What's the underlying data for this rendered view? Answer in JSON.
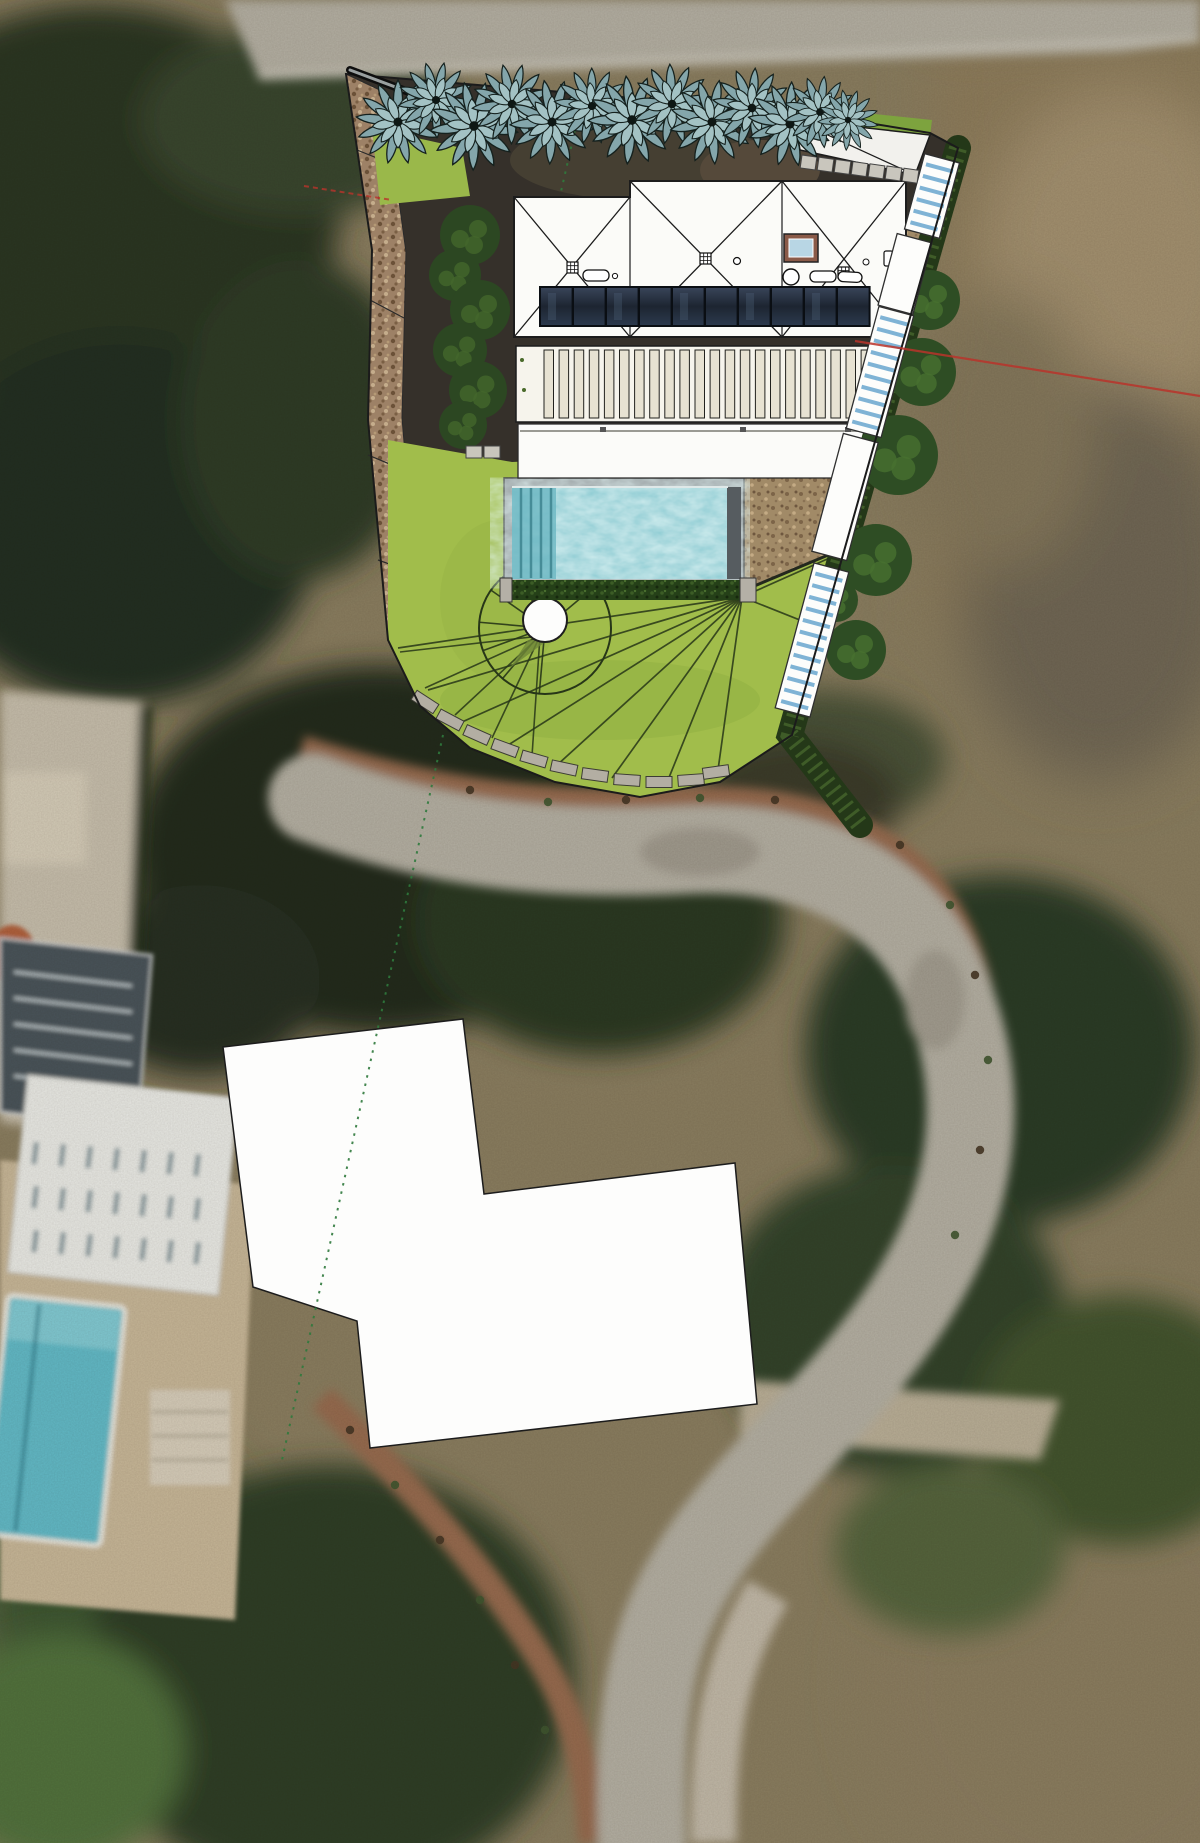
{
  "colors": {
    "bg_base": "#8a7d60",
    "road": "#b4afa3",
    "sidewalk_brown": "#966a50",
    "photo_tree_dark": "#2b3424",
    "photo_field_tan": "#8d7b5c",
    "plot_shadow": "#35302a",
    "lawn": "#a1bd4b",
    "lawn_wedge": "#9ab84a",
    "pool_water": "#79c4cd",
    "pool_step_line": "#468c97",
    "roof_white": "#fbfbf8",
    "terrace_white": "#fbfbf9",
    "louver_bg": "#f6f4ec",
    "louver_slat": "#e7e2d2",
    "solar_dark": "#242e3a",
    "plan_line": "#1b1b1b",
    "fan_line": "#273618",
    "wall_block": "#b3aea3",
    "hedge_dark": "#2c4722",
    "hedge_light": "#43662c",
    "tree_leaf": "#84a6ab",
    "tree_leaf_inner": "#a3c2c4",
    "tree_outline": "#15211e",
    "white_mask": "#fdfdfc",
    "dotted_green": "#2f7a3d",
    "red_line": "#b9342b",
    "deck": "#c7b698",
    "bldg_roof_dark": "#49525a",
    "bldg_roof_white": "#e9e9e5",
    "bldg_pool": "#62b9c7",
    "steps_tread_blue": "#7fb3d5",
    "skylight_frame": "#8a5a48",
    "skylight_glass": "#b8d6e4",
    "green_strip": "#7da33e"
  },
  "plan": {
    "boundary_points": "346,74 800,112 930,133 958,148 792,735 720,782 640,797 555,782 470,748 420,706 388,640 368,420 372,250",
    "gravel_points": "346,74 372,250 368,420 388,640 420,632 402,418 406,252 384,92",
    "lawn_points": "388,440 512,462 740,452 876,445 792,735 720,782 640,797 555,782 470,748 420,706 388,640",
    "lawn_wedge_points": "372,128 462,148 470,196 380,205",
    "roof_points": "514,197 630,197 630,181 906,181 906,337 514,337",
    "louver_points": "516,346 899,346 877,422 516,422",
    "terrace_points": "518,424 872,424 857,478 518,478",
    "brown_se_points": "740,452 878,445 852,545 740,592",
    "brown_ne_points": "902,222 938,218 918,320 902,316",
    "green_ne_points": "902,316 916,320 876,460",
    "driveway_points": "795,120 930,135 915,175 800,150",
    "driveway_green_points": "798,106 932,120 930,136 796,122",
    "white_mask_points": "223,1047 463,1019 484,1194 735,1163 757,1404 370,1448 357,1321 253,1287",
    "tree_row": [
      [
        398,
        122,
        1,
        0
      ],
      [
        436,
        100,
        0.9,
        40
      ],
      [
        474,
        126,
        1.05,
        15
      ],
      [
        512,
        104,
        0.95,
        70
      ],
      [
        552,
        122,
        1,
        100
      ],
      [
        592,
        106,
        0.9,
        55
      ],
      [
        632,
        120,
        1.05,
        20
      ],
      [
        672,
        104,
        0.95,
        80
      ],
      [
        712,
        122,
        1,
        10
      ],
      [
        752,
        108,
        0.95,
        60
      ],
      [
        790,
        124,
        1,
        30
      ],
      [
        820,
        112,
        0.85,
        90
      ],
      [
        848,
        120,
        0.72,
        45
      ]
    ],
    "tree_symbol": {
      "outer_petals": 13,
      "outer_r": 42,
      "inner_petals": 9,
      "inner_r": 26
    },
    "solar_panels": {
      "x0": 540,
      "y": 287,
      "w": 32.6,
      "h": 39,
      "count": 10
    },
    "louvers": {
      "x0": 544,
      "y": 350,
      "w": 9.5,
      "step": 15.1,
      "h": 68,
      "count": 23
    },
    "fan": {
      "origin": [
        742,
        597
      ],
      "left": [
        [
          398,
          648
        ],
        [
          428,
          690
        ],
        [
          462,
          722
        ],
        [
          505,
          747
        ],
        [
          556,
          766
        ],
        [
          612,
          778
        ],
        [
          668,
          780
        ],
        [
          718,
          770
        ]
      ],
      "right": [
        [
          850,
          640
        ],
        [
          870,
          540
        ],
        [
          876,
          447
        ]
      ]
    },
    "garden_circle": {
      "cx": 545,
      "cy": 628,
      "r": 66,
      "angles": [
        95,
        130,
        160,
        185,
        215,
        245,
        275,
        320
      ]
    },
    "spokes": {
      "origin": [
        540,
        636
      ],
      "targets": [
        [
          400,
          652
        ],
        [
          425,
          688
        ],
        [
          455,
          715
        ],
        [
          492,
          738
        ],
        [
          532,
          756
        ]
      ]
    },
    "white_circle": {
      "cx": 545,
      "cy": 620,
      "r": 22
    },
    "wall_blocks": [
      [
        425,
        702,
        33
      ],
      [
        450,
        720,
        28
      ],
      [
        477,
        735,
        24
      ],
      [
        505,
        748,
        20
      ],
      [
        534,
        759,
        16
      ],
      [
        564,
        768,
        12
      ],
      [
        595,
        775,
        8
      ],
      [
        627,
        780,
        4
      ],
      [
        659,
        782,
        0
      ],
      [
        691,
        780,
        -4
      ],
      [
        716,
        772,
        -8
      ]
    ],
    "steps_walkway": {
      "rot": 15,
      "width": 36,
      "items": [
        [
          932,
          196,
          78,
          "flight"
        ],
        [
          905,
          274,
          74,
          "landing"
        ],
        [
          880,
          372,
          126,
          "flight"
        ],
        [
          845,
          497,
          122,
          "landing"
        ],
        [
          812,
          640,
          150,
          "flight"
        ]
      ]
    },
    "hedge_w": [
      [
        470,
        235,
        30
      ],
      [
        455,
        275,
        26
      ],
      [
        480,
        310,
        30
      ],
      [
        460,
        350,
        27
      ],
      [
        478,
        390,
        29
      ],
      [
        463,
        425,
        24
      ]
    ],
    "trees_e": [
      [
        930,
        300,
        30
      ],
      [
        922,
        372,
        34
      ],
      [
        898,
        455,
        40
      ],
      [
        876,
        560,
        36
      ],
      [
        856,
        650,
        30
      ],
      [
        836,
        600,
        22
      ]
    ],
    "hedge_se": {
      "x1": 958,
      "y1": 148,
      "x2": 790,
      "y2": 735,
      "ext_x": 860,
      "ext_y": 825
    },
    "paver_pair": [
      [
        466,
        446
      ],
      [
        484,
        446
      ]
    ],
    "driveway_pavers": {
      "x0": 802,
      "y0": 155,
      "count": 7,
      "dx": 17,
      "w": 15,
      "h": 13,
      "rot": 8
    },
    "gate_pipe": [
      350,
      70,
      414,
      94
    ],
    "facet_lines": [
      [
        357,
        150,
        402,
        168
      ],
      [
        370,
        300,
        404,
        318
      ],
      [
        368,
        455,
        404,
        470
      ],
      [
        378,
        560,
        412,
        572
      ]
    ],
    "green_dotted": {
      "seg1": [
        575,
        130,
        560,
        196
      ],
      "seg2": [
        443,
        735,
        282,
        1460
      ]
    },
    "red_line": [
      855,
      341,
      1200,
      396
    ],
    "red_dashed": [
      304,
      186,
      392,
      200
    ]
  },
  "photo": {
    "band_dots": [
      [
        470,
        790
      ],
      [
        548,
        802
      ],
      [
        626,
        800
      ],
      [
        700,
        798
      ],
      [
        775,
        800
      ],
      [
        845,
        815
      ],
      [
        900,
        845
      ],
      [
        950,
        905
      ],
      [
        975,
        975
      ],
      [
        988,
        1060
      ],
      [
        980,
        1150
      ],
      [
        955,
        1235
      ],
      [
        350,
        1430
      ],
      [
        395,
        1485
      ],
      [
        440,
        1540
      ],
      [
        480,
        1600
      ],
      [
        515,
        1665
      ],
      [
        545,
        1730
      ]
    ],
    "skylight_rows": {
      "x0": 34,
      "y0": 1142,
      "cols": 7,
      "rows": 3,
      "dx": 27,
      "dy": 44,
      "w": 5,
      "h": 22,
      "rot": 7
    },
    "dark_roof_slats": 5
  }
}
